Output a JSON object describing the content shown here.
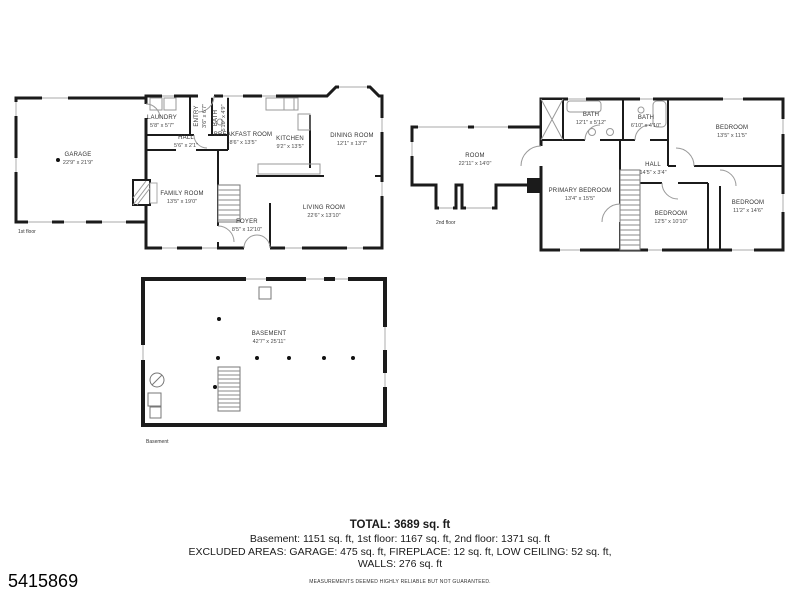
{
  "colors": {
    "wall": "#1b1b1b",
    "window": "#bbbbbb",
    "fixture": "#999999",
    "text": "#1a1a1a"
  },
  "listing_id": "5415869",
  "summary": {
    "total": "TOTAL: 3689 sq. ft",
    "line1": "Basement: 1151 sq. ft, 1st floor: 1167 sq. ft, 2nd floor: 1371 sq. ft",
    "line2": "EXCLUDED AREAS: GARAGE: 475 sq. ft, FIREPLACE: 12 sq. ft, LOW CEILING: 52 sq. ft,",
    "line3": "WALLS: 276 sq. ft",
    "disclaimer": "MEASUREMENTS DEEMED HIGHLY RELIABLE BUT NOT GUARANTEED."
  },
  "floors": {
    "first": {
      "label": "1st floor",
      "rooms": [
        {
          "name": "GARAGE",
          "dims": "22'9\" x 21'9\""
        },
        {
          "name": "LAUNDRY",
          "dims": "5'8\" x 5'7\""
        },
        {
          "name": "ENTRY",
          "dims": "3'6\" x 6'7\""
        },
        {
          "name": "BATH",
          "dims": "5'10\" x 4'9\""
        },
        {
          "name": "HALL",
          "dims": "5'6\" x 2'1\""
        },
        {
          "name": "BREAKFAST ROOM",
          "dims": "8'6\" x 13'5\""
        },
        {
          "name": "KITCHEN",
          "dims": "9'2\" x 13'5\""
        },
        {
          "name": "DINING ROOM",
          "dims": "12'1\" x 13'7\""
        },
        {
          "name": "FAMILY ROOM",
          "dims": "13'5\" x 19'0\""
        },
        {
          "name": "FOYER",
          "dims": "8'5\" x 12'10\""
        },
        {
          "name": "LIVING ROOM",
          "dims": "22'6\" x 13'10\""
        }
      ]
    },
    "second": {
      "label": "2nd floor",
      "rooms": [
        {
          "name": "ROOM",
          "dims": "22'11\" x 14'0\""
        },
        {
          "name": "BATH",
          "dims": "12'1\" x 5'12\""
        },
        {
          "name": "BATH",
          "dims": "6'10\" x 4'10\""
        },
        {
          "name": "BEDROOM",
          "dims": "13'5\" x 11'5\""
        },
        {
          "name": "PRIMARY BEDROOM",
          "dims": "13'4\" x 15'5\""
        },
        {
          "name": "HALL",
          "dims": "14'5\" x 3'4\""
        },
        {
          "name": "BEDROOM",
          "dims": "12'5\" x 10'10\""
        },
        {
          "name": "BEDROOM",
          "dims": "11'2\" x 14'6\""
        }
      ]
    },
    "basement": {
      "label": "Basement",
      "rooms": [
        {
          "name": "BASEMENT",
          "dims": "42'7\" x 25'11\""
        }
      ]
    }
  }
}
